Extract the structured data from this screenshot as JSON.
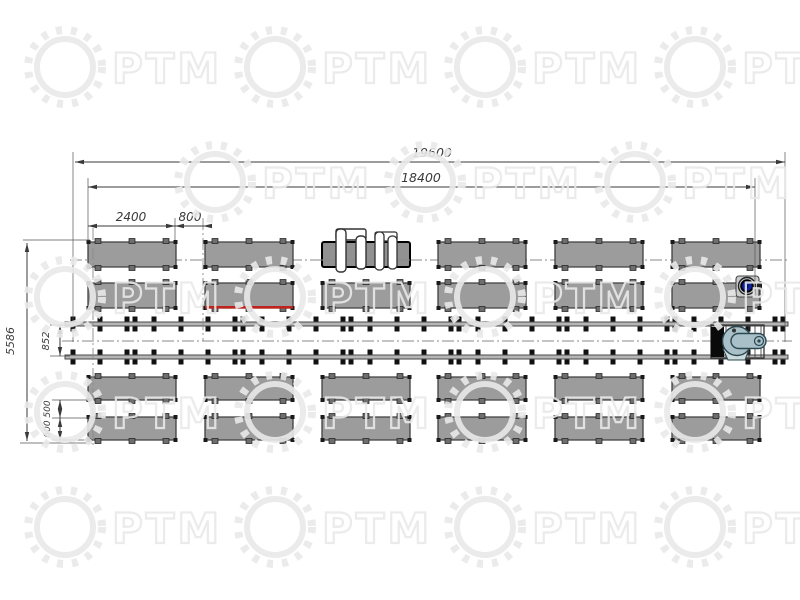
{
  "page": {
    "background": "#ffffff",
    "title": ""
  },
  "watermark": {
    "text": "РТМ",
    "color": "#e9e9e9"
  },
  "dimensions": {
    "total_length": "19600",
    "working_line_length": "18400",
    "table_length": "2400",
    "table_gap": "800",
    "layout_height": "5586",
    "rail_gauge": "852",
    "row_gap": "500",
    "table_width": "600"
  },
  "colors": {
    "table_fill": "#9c9c9c",
    "table_border": "#3f3f3f",
    "tab_fill": "#6e6e6e",
    "foot_fill": "#1a1a1a",
    "rail_fill": "#b5b5b5",
    "rail_border": "#4a4a4a",
    "clamp": "#111111",
    "dimension": "#3a3a3a",
    "centerline": "#8a8a8a",
    "highlight_red": "#c0231d",
    "device_blue": "#0b22a8",
    "machine_body": "#a9c0c9",
    "machine_outline": "#2b4850"
  },
  "layout": {
    "columns_x": [
      88,
      205,
      322,
      438,
      555,
      672
    ],
    "table_w": 88,
    "rows": [
      {
        "y": 242,
        "h": 25
      },
      {
        "y": 283,
        "h": 25
      },
      {
        "y": 377,
        "h": 23
      },
      {
        "y": 417,
        "h": 23
      }
    ],
    "special": {
      "turnover_row": 0,
      "turnover_col": 2,
      "red_row": 1,
      "red_col": 1,
      "blue_row": 1,
      "blue_col": 5
    },
    "rails": {
      "x1": 65,
      "x2": 788,
      "y_top": 322,
      "y_bottom": 355,
      "bar_h": 4,
      "clamp_start": 73,
      "clamp_step": 27,
      "clamp_count": 27,
      "double_start": 2,
      "double_every": 4,
      "double_offset": 8
    },
    "watermarks": [
      {
        "y": 25,
        "xs": [
          20,
          230,
          440,
          650
        ]
      },
      {
        "y": 140,
        "xs": [
          170,
          380,
          590
        ]
      },
      {
        "y": 255,
        "xs": [
          20,
          230,
          440,
          650
        ]
      },
      {
        "y": 370,
        "xs": [
          20,
          230,
          440,
          650
        ]
      },
      {
        "y": 485,
        "xs": [
          20,
          230,
          440,
          650
        ]
      }
    ]
  }
}
